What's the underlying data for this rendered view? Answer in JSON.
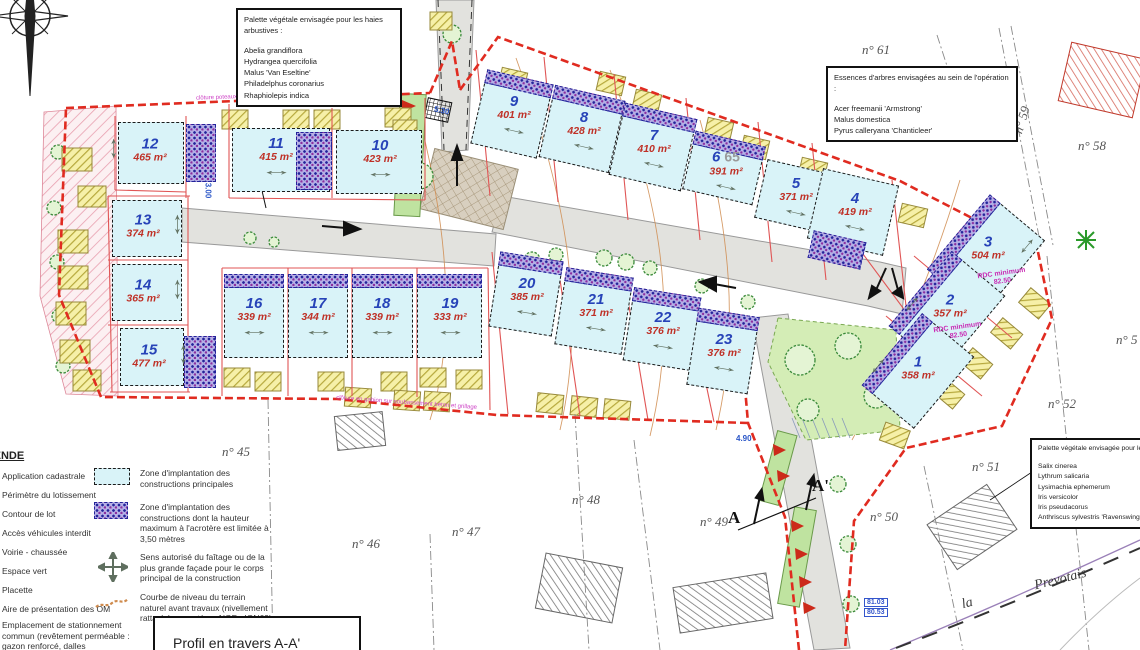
{
  "boxes": {
    "shrub": {
      "title": "Palette végétale envisagée pour les haies arbustives :",
      "items": [
        "Abelia grandiflora",
        "Hydrangea quercifolia",
        "Malus 'Van Eseltine'",
        "Philadelphus coronarius",
        "Rhaphiolepis indica"
      ]
    },
    "trees": {
      "title": "Essences d'arbres envisagées au sein de l'opération :",
      "items": [
        "Acer freemanii 'Armstrong'",
        "Malus domestica",
        "Pyrus calleryana 'Chanticleer'"
      ]
    },
    "wet": {
      "title": "Palette végétale envisagée pour le",
      "items": [
        "Salix cinerea",
        "Lythrum salicaria",
        "Lysimachia ephemerum",
        "Iris versicolor",
        "Iris pseudacorus",
        "Anthriscus sylvestris 'Ravenswing'"
      ]
    }
  },
  "legend": {
    "title": "LÉGENDE",
    "col1": [
      "Application cadastrale",
      "Périmètre du lotissement",
      "Contour de lot",
      "Accès véhicules interdit",
      "Voirie - chaussée",
      "Espace vert",
      "Placette",
      "Aire de présentation des OM",
      "Emplacement de stationnement commun (revêtement perméable : gazon renforcé, dalles enherbées...)"
    ],
    "col2": [
      "Zone d'implantation des constructions principales",
      "Zone d'implantation des constructions dont la hauteur maximum à l'acrotère est limitée à 3,50 mètres",
      "Sens autorisé du faîtage ou de la plus grande façade pour le corps principal de la construction",
      "Courbe de niveau du terrain naturel avant travaux (nivellement rattaché au système NGF - IGN69)"
    ]
  },
  "profile": {
    "title": "Profil en travers A-A'"
  },
  "lots": [
    {
      "num": "1",
      "area": "358 m²"
    },
    {
      "num": "2",
      "area": "357 m²"
    },
    {
      "num": "3",
      "area": "504 m²"
    },
    {
      "num": "4",
      "area": "419 m²"
    },
    {
      "num": "5",
      "area": "371 m²"
    },
    {
      "num": "6",
      "area": "391 m²"
    },
    {
      "num": "7",
      "area": "410 m²"
    },
    {
      "num": "8",
      "area": "428 m²"
    },
    {
      "num": "9",
      "area": "401 m²"
    },
    {
      "num": "10",
      "area": "423 m²"
    },
    {
      "num": "11",
      "area": "415 m²"
    },
    {
      "num": "12",
      "area": "465 m²"
    },
    {
      "num": "13",
      "area": "374 m²"
    },
    {
      "num": "14",
      "area": "365 m²"
    },
    {
      "num": "15",
      "area": "477 m²"
    },
    {
      "num": "16",
      "area": "339 m²"
    },
    {
      "num": "17",
      "area": "344 m²"
    },
    {
      "num": "18",
      "area": "339 m²"
    },
    {
      "num": "19",
      "area": "333 m²"
    },
    {
      "num": "20",
      "area": "385 m²"
    },
    {
      "num": "21",
      "area": "371 m²"
    },
    {
      "num": "22",
      "area": "376 m²"
    },
    {
      "num": "23",
      "area": "376 m²"
    }
  ],
  "parcels": {
    "p45": "n° 45",
    "p46": "n° 46",
    "p47": "n° 47",
    "p48": "n° 48",
    "p49": "n° 49",
    "p50": "n° 50",
    "p51": "n° 51",
    "p52": "n° 52",
    "p58": "n° 58",
    "p59": "n° 59",
    "p60": "n° 60",
    "p61": "n° 61",
    "p65": "65",
    "p5x": "n° 5"
  },
  "street": {
    "part1": "la",
    "part2": "Prevotais"
  },
  "annotations": {
    "rdc1_l1": "RDC minimum",
    "rdc1_l2": "82.50",
    "rdc2_l1": "RDC minimum",
    "rdc2_l2": "82.50",
    "level_top": "81.03",
    "level_bottom": "80.53",
    "dim1": "5.30",
    "dim2": "4.90",
    "dim3": "3.00",
    "section_a": "A",
    "section_a_prime": "A'",
    "fence_top": "clôture poteaux fer et grillage rigide",
    "fence_bottom": "clôture en gabion sur soubassement béton et grillage"
  }
}
